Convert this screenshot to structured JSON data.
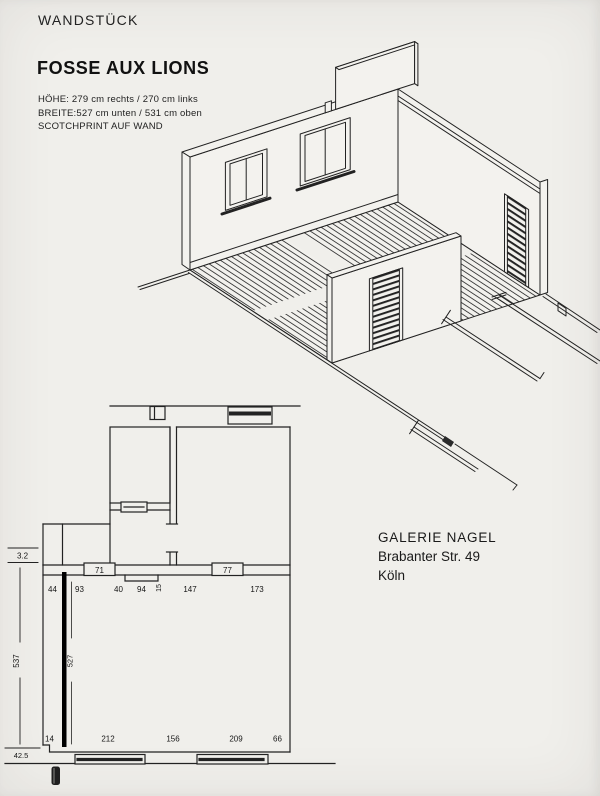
{
  "header": {
    "document_title": "WANDSTÜCK",
    "artwork_title": "FOSSE AUX LIONS",
    "spec_lines": [
      "HÖHE: 279 cm rechts / 270 cm links",
      "BREITE:527 cm unten / 531 cm oben",
      "SCOTCHPRINT AUF WAND"
    ]
  },
  "gallery": {
    "name": "GALERIE NAGEL",
    "street": "Brabanter Str. 49",
    "city": "Köln"
  },
  "floor_plan": {
    "opening_labels": {
      "left_box": "71",
      "right_box": "77"
    },
    "top_dims": [
      "44",
      "93",
      "40",
      "94",
      "15",
      "147",
      "173"
    ],
    "bottom_dims": [
      "14",
      "212",
      "156",
      "209",
      "66"
    ],
    "left_dims": {
      "top": "3.2",
      "middle": "537",
      "bottom": "42.5"
    },
    "artwork_length": "527"
  },
  "colors": {
    "paper": "#f0efeb",
    "ink": "#222222"
  }
}
